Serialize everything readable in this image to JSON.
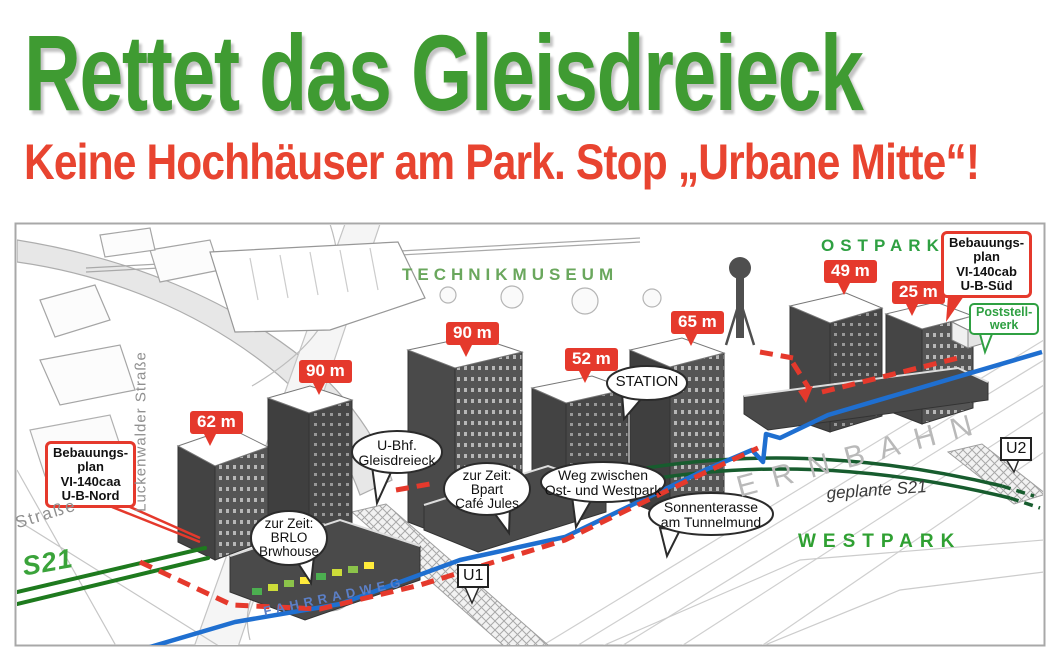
{
  "header": {
    "title": "Rettet das Gleisdreieck",
    "subtitle": "Keine Hochhäuser am Park. Stop „Urbane Mitte“!"
  },
  "map": {
    "area_labels": {
      "technikmuseum": "TECHNIKMUSEUM",
      "ostpark": "OSTPARK",
      "westpark": "WESTPARK"
    },
    "height_markers": [
      {
        "label": "62 m"
      },
      {
        "label": "90 m"
      },
      {
        "label": "90 m"
      },
      {
        "label": "52 m"
      },
      {
        "label": "65 m"
      },
      {
        "label": "49 m"
      },
      {
        "label": "25 m"
      }
    ],
    "plan_box_nord": {
      "line1": "Bebauungs-",
      "line2": "plan",
      "line3": "VI-140caa",
      "line4": "U-B-Nord"
    },
    "plan_box_sued": {
      "line1": "Bebauungs-",
      "line2": "plan",
      "line3": "VI-140cab",
      "line4": "U-B-Süd"
    },
    "poststellwerk": {
      "line1": "Poststell-",
      "line2": "werk"
    },
    "bubbles": {
      "station": {
        "line1": "STATION"
      },
      "ubhf": {
        "line1": "U-Bhf.",
        "line2": "Gleisdreieck"
      },
      "brlo": {
        "line1": "zur Zeit:",
        "line2": "BRLO",
        "line3": "Brwhouse"
      },
      "bpart": {
        "line1": "zur Zeit:",
        "line2": "Bpart",
        "line3": "Café Jules"
      },
      "weg": {
        "line1": "Weg zwischen",
        "line2": "Ost- und Westpark"
      },
      "sonnenterrasse": {
        "line1": "Sonnenterasse",
        "line2": "am Tunnelmund"
      }
    },
    "transit": {
      "u1": "U1",
      "u2": "U2"
    },
    "rail_labels": {
      "s21": "S21",
      "geplante_s21": "geplante S21",
      "fahrradweg": "FAHRRADWEG",
      "fernbahn": "ERNBAHN"
    },
    "streets": {
      "luckenwalder": "Luckenwalder Straße",
      "strasse": "Straße"
    },
    "colors": {
      "title_green": "#3f9b32",
      "subtitle_red": "#e84430",
      "marker_red": "#e5392c",
      "park_green": "#2fa042",
      "s21_track_green": "#1e7a1e",
      "planned_s21_green": "#175c2e",
      "bike_path_blue": "#1f6fd0",
      "fahrradweg_blue": "#5b7fc7"
    }
  }
}
